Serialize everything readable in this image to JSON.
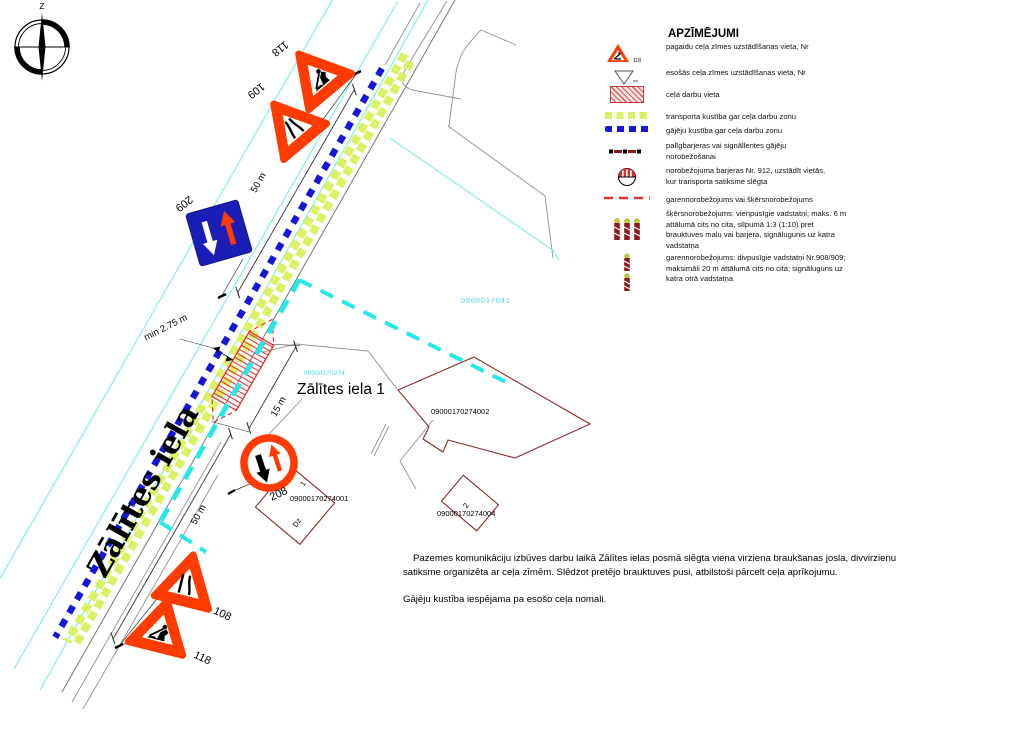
{
  "legend": {
    "title": "APZĪMĒJUMI",
    "sign_number": "118",
    "items": [
      "pagaidu ceļa zīmes uzstādīšanas vieta, Nr",
      "esošās ceļa zīmes uzstādīšanas vieta, Nr",
      "ceļa darbu vieta",
      "transporta kustība gar ceļa darbu zonu",
      "gājēju kustība gar ceļa darbu zonu",
      "palīgbarjeras vai signāllentes gājēju\nnorobežošanai",
      "norobežojuma barjeras Nr. 912, uzstādīt vietās,\nkur transporta satiksme slēgta",
      "garennorobežojums vai šķērsnorobežojums",
      "šķērsnorobežojums: vienpusīgie vadstatņi; maks. 6 m\nattālumā cits no cita, slīpumā 1:3 (1:10) pret\nbrauktuves malu vai barjera, signālugunis uz katra\nvadstatņa",
      "garennorobežojums: divpusīgie vadstatņi Nr.908/909;\nmaksimāli 20 m attālumā cits no cita; signāluguns uz\nkatra otrā vadstatņa"
    ]
  },
  "notes": {
    "p1": "Pazemes komunikāciju izbūves darbu laikā Zālītes ielas posmā slēgta viena virziena braukšanas josla, divvirzienu satiksme organizēta ar ceļa zīmēm. Slēdzot pretējo brauktuves pusi, atbilstoši pārcelt ceļa aprīkojumu.",
    "p2": "Gājēju kustība iespējama pa esošo ceļa nomali."
  },
  "map": {
    "compass_north": "Z",
    "street_label": "Zālītes iela",
    "address_label": "Zālītes iela 1",
    "cadastre": {
      "road_parcel": "0900017041",
      "property_parcel": "09000170274",
      "building_main": "09000170274002",
      "building_dwelling": "09000170274001",
      "building_small": "09000170274004",
      "dwelling_mark": "Dz",
      "dwelling_floors": "1",
      "small_floors": "2"
    },
    "signs": {
      "top_roadworks": "118",
      "top_narrow": "109",
      "oncoming_priority": "209",
      "give_way_oncoming": "208",
      "bottom_narrow": "108",
      "bottom_roadworks": "118"
    },
    "dimensions": {
      "top_distance": "50 m",
      "bottom_distance": "50 m",
      "lane_width": "min 2.75 m",
      "work_zone_length": "15 m"
    }
  },
  "colors": {
    "sign_red": "#ff3b00",
    "sign_blue": "#1b1eb6",
    "pedestrian_blue": "#1616d8",
    "transport_green": "#d9f163",
    "boundary_cyan": "#25e9e9",
    "edge_cyan": "#7fe9e9",
    "work_zone_red": "#e23333",
    "building_dark_red": "#8f2b2b"
  }
}
